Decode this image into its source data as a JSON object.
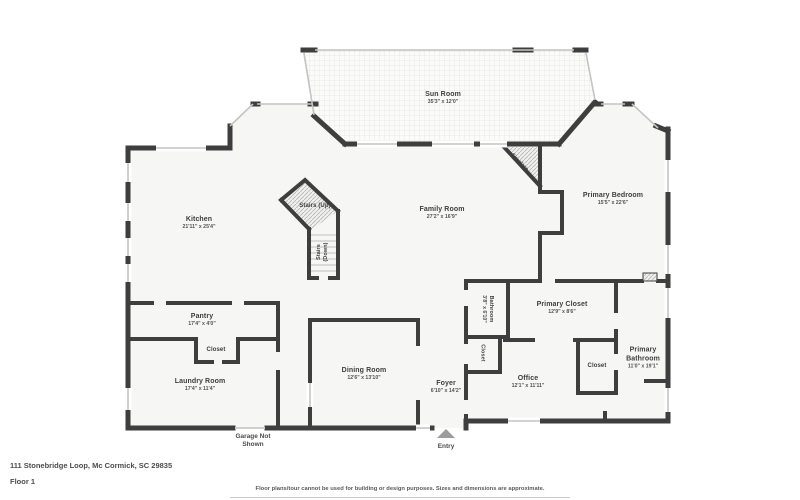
{
  "colors": {
    "wall": "#3e3e3e",
    "floor": "#f6f6f5",
    "window_line": "#c4c4c4",
    "text": "#3e3e3e",
    "entry_marker": "#9c9c9c",
    "background": "#ffffff"
  },
  "rooms": {
    "sun_room": {
      "name": "Sun Room",
      "dims": "35'3\" x 12'0\""
    },
    "primary_bedroom": {
      "name": "Primary Bedroom",
      "dims": "15'5\" x 22'6\""
    },
    "kitchen": {
      "name": "Kitchen",
      "dims": "21'11\" x 25'4\""
    },
    "family_room": {
      "name": "Family Room",
      "dims": "27'2\" x 16'9\""
    },
    "stairs_up": {
      "name": "Stairs (Up)"
    },
    "stairs_down": {
      "name": "Stairs (Down)"
    },
    "fireplace": {
      "name": "Fireplace"
    },
    "pantry": {
      "name": "Pantry",
      "dims": "17'4\" x 4'0\""
    },
    "closet_pantry": {
      "name": "Closet"
    },
    "laundry_room": {
      "name": "Laundry Room",
      "dims": "17'4\" x 11'4\""
    },
    "dining_room": {
      "name": "Dining Room",
      "dims": "12'6\" x 13'10\""
    },
    "foyer": {
      "name": "Foyer",
      "dims": "6'10\" x 14'2\""
    },
    "bathroom": {
      "name": "Bathroom",
      "dims": "3'8\" x 6'10\""
    },
    "closet_hall": {
      "name": "Closet"
    },
    "primary_closet": {
      "name": "Primary Closet",
      "dims": "12'9\" x 8'6\""
    },
    "office": {
      "name": "Office",
      "dims": "12'1\" x 11'11\""
    },
    "closet_bedroom": {
      "name": "Closet"
    },
    "primary_bathroom": {
      "name": "Primary Bathroom",
      "dims": "11'0\" x 19'1\""
    }
  },
  "annotations": {
    "garage_note": "Garage Not Shown",
    "entry": "Entry"
  },
  "footer": {
    "address": "111 Stonebridge Loop, Mc Cormick, SC 29835",
    "floor_label": "Floor 1",
    "disclaimer": "Floor plans/tour cannot be used for building or design purposes. Sizes and dimensions are approximate."
  }
}
